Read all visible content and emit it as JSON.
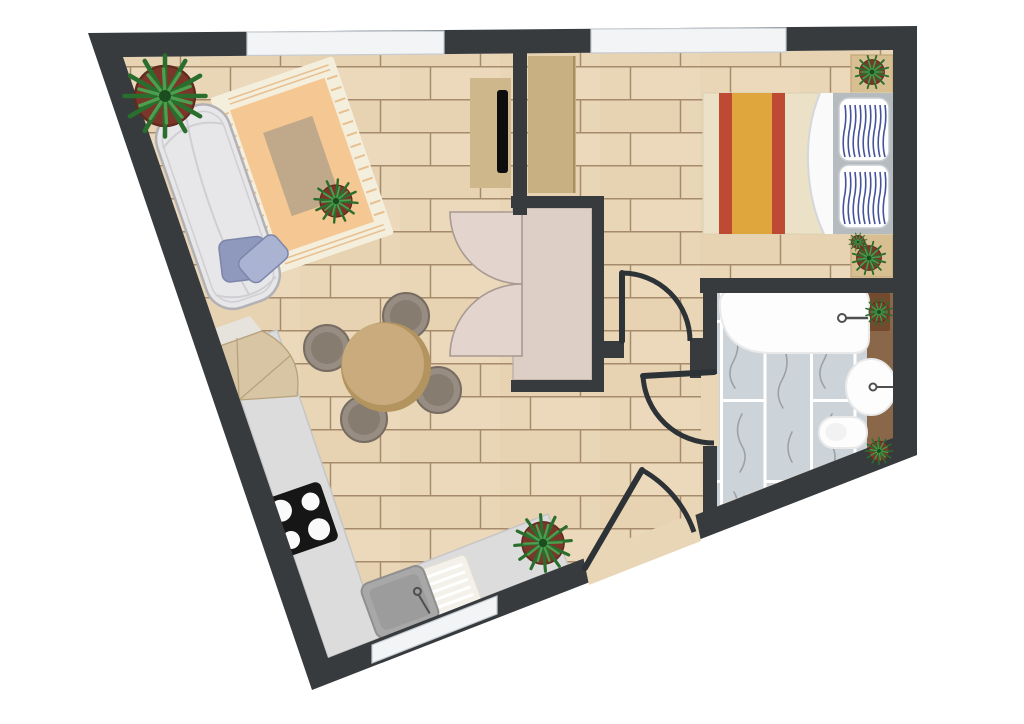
{
  "scene": {
    "kind": "apartment-floor-plan-top-view",
    "has_text": false
  },
  "colors": {
    "background": "#ffffff",
    "wall": "#373b3e",
    "door": "#2d3236",
    "window_glass": "#f2f4f6",
    "window_frame": "#c6ccd1",
    "floor_wood": "#e9d6b6",
    "floor_wood_light": "#efdfc3",
    "floor_wood_dark": "#e3ceab",
    "floor_wood_line": "#a58b6b",
    "marble_tile": "#cdd4d9",
    "marble_grout": "#ffffff",
    "marble_vein": "#8a9094",
    "rug_border": "#f4eedd",
    "rug_field": "#f5c792",
    "rug_center": "#bfa98a",
    "rug_fringe": "#e8bf8e",
    "sofa": "#e7e7e9",
    "sofa_stroke": "#b2b2b6",
    "sofa_seam": "#cfcfd3",
    "pillow_blue_dark": "#8f99bd",
    "pillow_blue_light": "#aab3d2",
    "pillow_blue_stroke": "#7d86aa",
    "table_top": "#c9ab7d",
    "table_rim": "#b3945f",
    "chair": "#978d82",
    "chair_inner": "#867c70",
    "chair_stroke": "#766c61",
    "counter": "#dcdcdc",
    "counter_edge": "#c6c6c6",
    "corner_unit": "#d8c5a3",
    "corner_unit_line": "#b7a27e",
    "end_cap": "#e6e3dd",
    "cooktop": "#161616",
    "burner": "#fafafa",
    "sink_basin": "#a8a8a8",
    "sink_basin_inner": "#9c9c9c",
    "sink_basin_stroke": "#8f8f8f",
    "drainboard": "#f3f1ea",
    "drainboard_line": "#ffffff",
    "faucet": "#4f4f4f",
    "closet_interior": "#ddcec6",
    "closet_interior_stroke": "#b9aaa2",
    "closet_door": "#e3d5cd",
    "closet_door_stroke": "#a89a92",
    "console": "#cfb78c",
    "tv": "#0e0e0e",
    "wardrobe": "#c9b083",
    "wardrobe_edge": "#a5905e",
    "bed_blanket": "#ebe1c6",
    "bed_blanket_stroke": "#dcd2b4",
    "bed_stripe_red": "#bf4a33",
    "bed_stripe_orange": "#dfa63e",
    "bed_sheet": "#fafafa",
    "bed_sheet_fold": "#d4d7d9",
    "bed_base": "#b5bbbf",
    "pillow_white": "#ffffff",
    "pillow_white_stroke": "#c8cdd1",
    "pillow_stripe": "#45539a",
    "nightstand": "#d7bf92",
    "nightstand_stroke": "#c3a878",
    "bath_counter": "#8a6749",
    "planter": "#734a2d",
    "fixture_white": "#fdfdfd",
    "fixture_stroke": "#e9e9e9",
    "toilet_bowl": "#f2f2f2",
    "plant_leaf_dark": "#2a6e2d",
    "plant_leaf_light": "#4d9f50",
    "plant_center": "#1c4d1f",
    "plant_pot": "#7c3629",
    "plant_pot_stroke": "#5e2b1d"
  },
  "rooms": [
    {
      "name": "living-room"
    },
    {
      "name": "dining-area"
    },
    {
      "name": "kitchen"
    },
    {
      "name": "hallway"
    },
    {
      "name": "bedroom"
    },
    {
      "name": "bathroom"
    },
    {
      "name": "closet"
    }
  ],
  "elements": [
    {
      "name": "sofa",
      "count": 1
    },
    {
      "name": "blue-throw-pillows",
      "count": 2
    },
    {
      "name": "area-rug",
      "count": 1
    },
    {
      "name": "potted-plant",
      "count": 8
    },
    {
      "name": "tv-console",
      "count": 1
    },
    {
      "name": "tv",
      "count": 1
    },
    {
      "name": "dining-table",
      "count": 1
    },
    {
      "name": "dining-chair",
      "count": 4
    },
    {
      "name": "kitchen-counter",
      "count": 1
    },
    {
      "name": "cooktop-burner",
      "count": 4
    },
    {
      "name": "kitchen-sink",
      "count": 1
    },
    {
      "name": "drainboard",
      "count": 1
    },
    {
      "name": "closet-double-door",
      "count": 2
    },
    {
      "name": "wardrobe",
      "count": 1
    },
    {
      "name": "double-bed",
      "count": 1
    },
    {
      "name": "bed-pillow",
      "count": 2
    },
    {
      "name": "nightstand",
      "count": 2
    },
    {
      "name": "bathtub",
      "count": 1
    },
    {
      "name": "washbasin",
      "count": 1
    },
    {
      "name": "toilet",
      "count": 1
    },
    {
      "name": "bathroom-counter",
      "count": 1
    },
    {
      "name": "window",
      "count": 3
    },
    {
      "name": "swing-door",
      "count": 3
    }
  ]
}
